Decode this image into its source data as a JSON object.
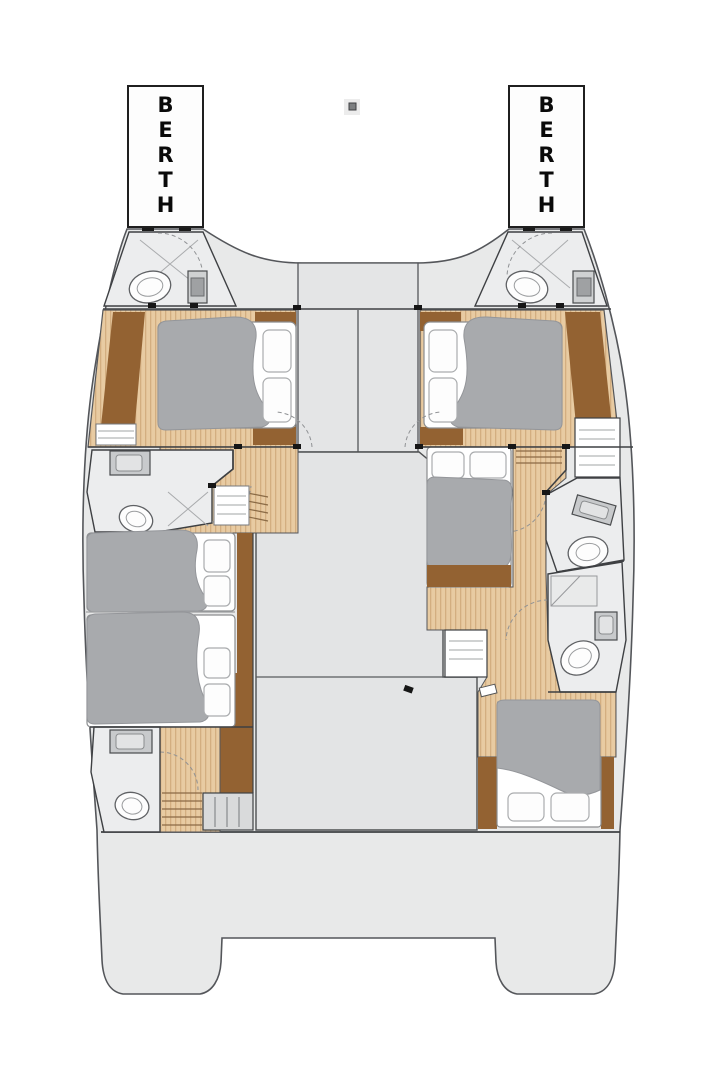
{
  "labels": {
    "port_berth": "BERTH",
    "starboard_berth": "BERTH"
  },
  "colors": {
    "background": "#ffffff",
    "hull": "#e8e9e9",
    "outline": "#54565a",
    "salon_panel": "#e3e4e5",
    "bathroom_floor": "#ecedee",
    "wood_floor": "#e8cba2",
    "wood_stripe": "#d3ae80",
    "dark_wood_trim": "#936232",
    "duvet_gray": "#a8aaad",
    "bed_white": "#ffffff",
    "label_text": "#0a0a0a"
  }
}
